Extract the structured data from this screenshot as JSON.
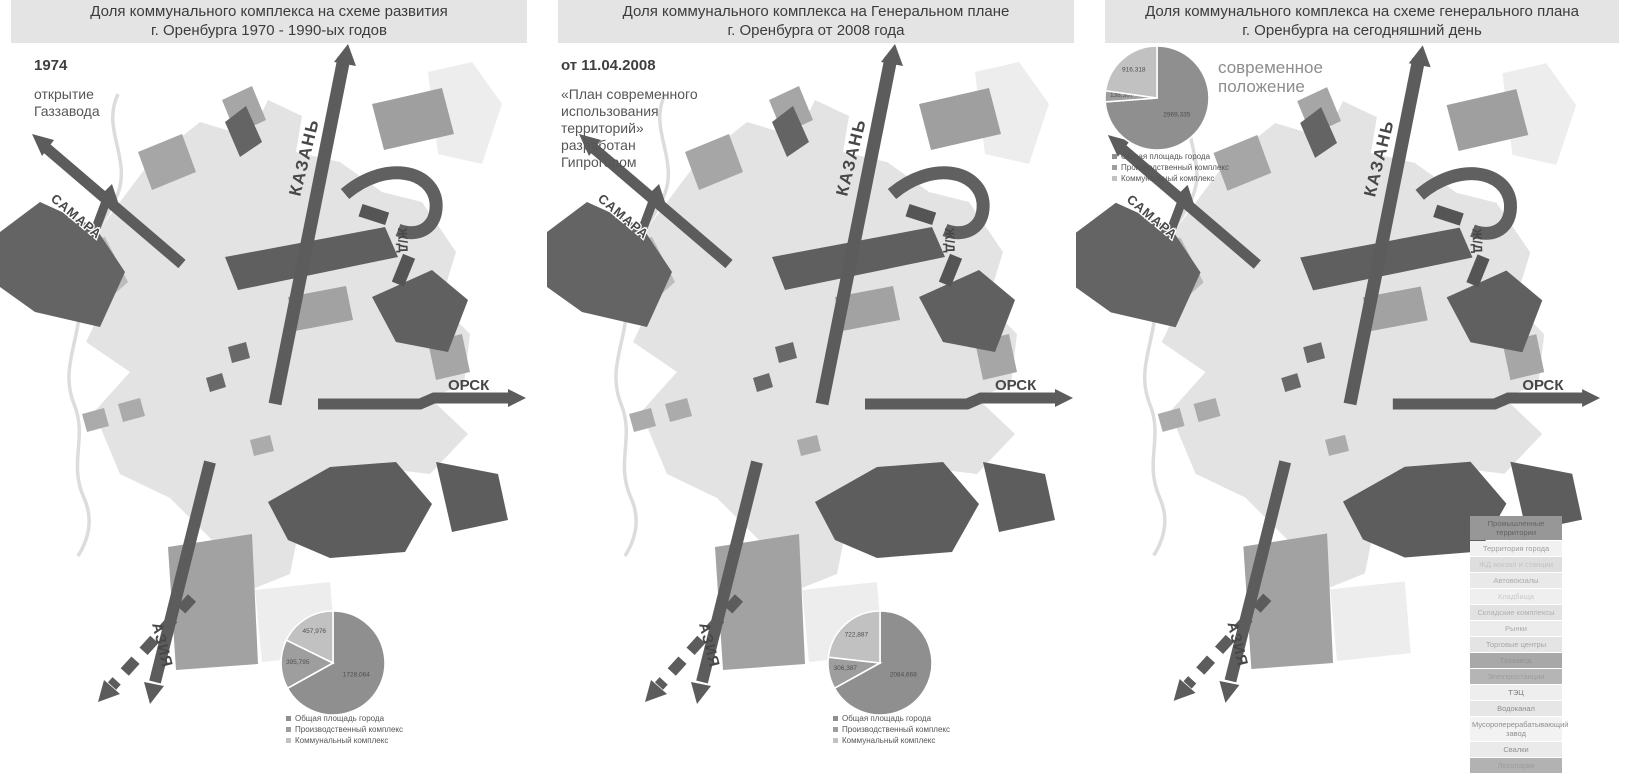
{
  "palette": {
    "title_bar_bg": "#e4e4e4",
    "title_text": "#3c3c3c",
    "map_city": "#e3e3e3",
    "map_medium": "#a2a2a2",
    "map_dark": "#5f5f5f",
    "road": "#5c5c5c"
  },
  "map_labels": {
    "kazan": "КАЗАНЬ",
    "samara": "САМАРА",
    "rail": "Ж/Д",
    "orsk": "ОРСК",
    "asia": "АЗИЯ"
  },
  "pie_legend": [
    "Общая площадь города",
    "Производственный комплекс",
    "Коммунальный комплекс"
  ],
  "pie_series_colors": [
    "#8f8f8f",
    "#9e9e9e",
    "#c1c1c1"
  ],
  "panels": [
    {
      "title1": "Доля коммунального комплекса на схеме развития",
      "title2": "г. Оренбурга 1970 - 1990-ых годов",
      "note_bold": "1974",
      "note_text": "открытие\nГаззавода"
    },
    {
      "title1": "Доля коммунального комплекса на Генеральном плане",
      "title2": "г. Оренбурга от 2008 года",
      "note_bold": "от 11.04.2008",
      "note_text": "«План современного\nиспользования\nтерриторий»\nразработан\nГипрогором"
    },
    {
      "title1": "Доля коммунального комплекса на схеме генерального плана",
      "title2": "г. Оренбурга на сегодняшний день",
      "note_bold": "",
      "note_text": "современное\nположение"
    }
  ],
  "chart_data": [
    {
      "type": "pie",
      "title": "Доля коммунального комплекса на схеме развития г. Оренбурга 1970 - 1990-ых годов",
      "labels": [
        "Общая площадь города",
        "Производственный комплекс",
        "Коммунальный комплекс"
      ],
      "values": [
        1728.064,
        395.795,
        457.976
      ],
      "values_text": [
        "1728,064",
        "395,795",
        "457,976"
      ],
      "colors": [
        "#8f8f8f",
        "#9e9e9e",
        "#c1c1c1"
      ],
      "legend_position": "bottom"
    },
    {
      "type": "pie",
      "title": "Доля коммунального комплекса на Генеральном плане г. Оренбурга от 2008 года",
      "labels": [
        "Общая площадь города",
        "Производственный комплекс",
        "Коммунальный комплекс"
      ],
      "values": [
        2084.668,
        306.387,
        722.887
      ],
      "values_text": [
        "2084,668",
        "306,387",
        "722,887"
      ],
      "colors": [
        "#8f8f8f",
        "#9e9e9e",
        "#c1c1c1"
      ],
      "legend_position": "bottom"
    },
    {
      "type": "pie",
      "title": "Доля коммунального комплекса на схеме генерального плана г. Оренбурга на сегодняшний день",
      "labels": [
        "Общая площадь города",
        "Производственный комплекс",
        "Коммунальный комплекс"
      ],
      "values": [
        2969.335,
        138.307,
        916.318
      ],
      "values_text": [
        "2969,335",
        "138,307",
        "916,318"
      ],
      "colors": [
        "#8f8f8f",
        "#9e9e9e",
        "#c1c1c1"
      ],
      "legend_position": "top-left"
    }
  ],
  "map_legend": {
    "items": [
      {
        "label": "Промышленные территории",
        "bg": "#979797",
        "fg": "#636363"
      },
      {
        "label": "Территория города",
        "bg": "#f1f1f1",
        "fg": "#9f9f9f"
      },
      {
        "label": "ЖД вокзал и станции",
        "bg": "#dedede",
        "fg": "#c3c3c3"
      },
      {
        "label": "Автовокзалы",
        "bg": "#e9e9e9",
        "fg": "#ababab"
      },
      {
        "label": "Кладбища",
        "bg": "#efefef",
        "fg": "#c9c9c9"
      },
      {
        "label": "Складские комплексы",
        "bg": "#e2e2e2",
        "fg": "#b0b0b0"
      },
      {
        "label": "Рынки",
        "bg": "#ececec",
        "fg": "#aaaaaa"
      },
      {
        "label": "Торговые центры",
        "bg": "#e4e4e4",
        "fg": "#a6a6a6"
      },
      {
        "label": "Газзавод",
        "bg": "#a8a8a8",
        "fg": "#949494"
      },
      {
        "label": "Электростанции",
        "bg": "#b5b5b5",
        "fg": "#9d9d9d"
      },
      {
        "label": "ТЭЦ",
        "bg": "#eeeeee",
        "fg": "#7c7c7c"
      },
      {
        "label": "Водоканал",
        "bg": "#e6e6e6",
        "fg": "#8f8f8f"
      },
      {
        "label": "Мусороперерабатывающий\nзавод",
        "bg": "#f2f2f2",
        "fg": "#8f8f8f"
      },
      {
        "label": "Свалки",
        "bg": "#eaeaea",
        "fg": "#8f8f8f"
      },
      {
        "label": "Лесопарки",
        "bg": "#b2b2b2",
        "fg": "#9c9c9c"
      }
    ]
  }
}
